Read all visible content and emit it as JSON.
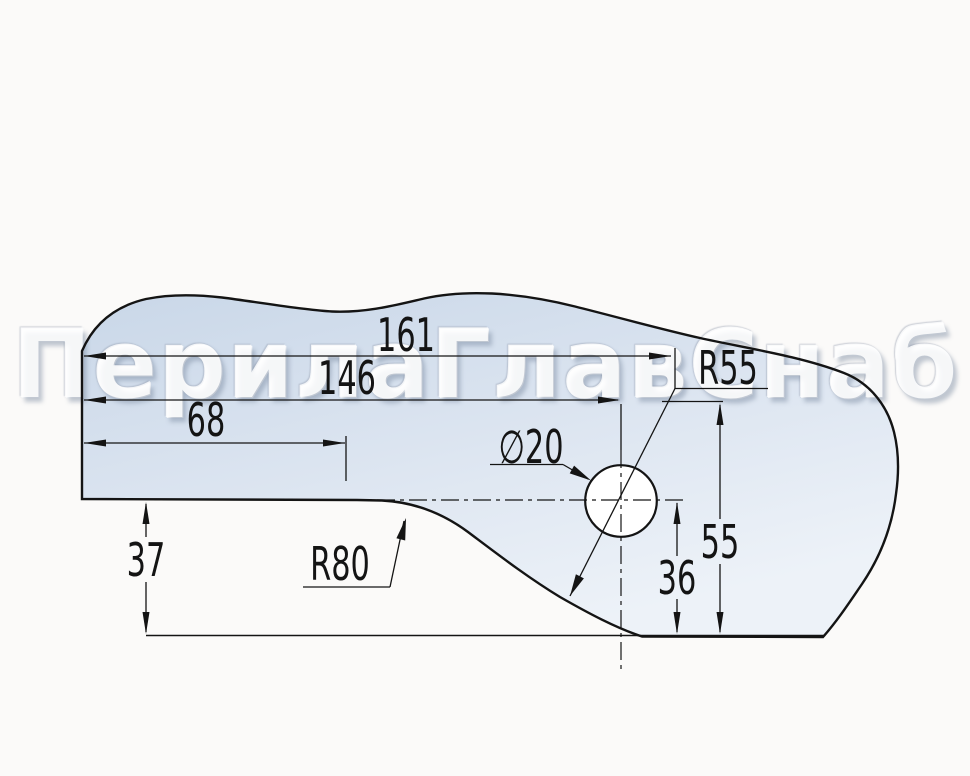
{
  "watermark": {
    "text": "ПерилаГлавСнаб"
  },
  "dimensions": {
    "total_length": "161",
    "hole_offset": "146",
    "step_length": "68",
    "left_drop": "37",
    "fillet_r80": "R80",
    "fillet_r55": "R55",
    "hole_diameter": "∅20",
    "overall_height_55": "55",
    "hole_height_36": "36"
  },
  "colors": {
    "background": "#fbfaf9",
    "part_fill_top": "#c9d7e8",
    "part_fill_bottom": "#edf2f8",
    "line": "#141414",
    "watermark": "#ffffff"
  }
}
